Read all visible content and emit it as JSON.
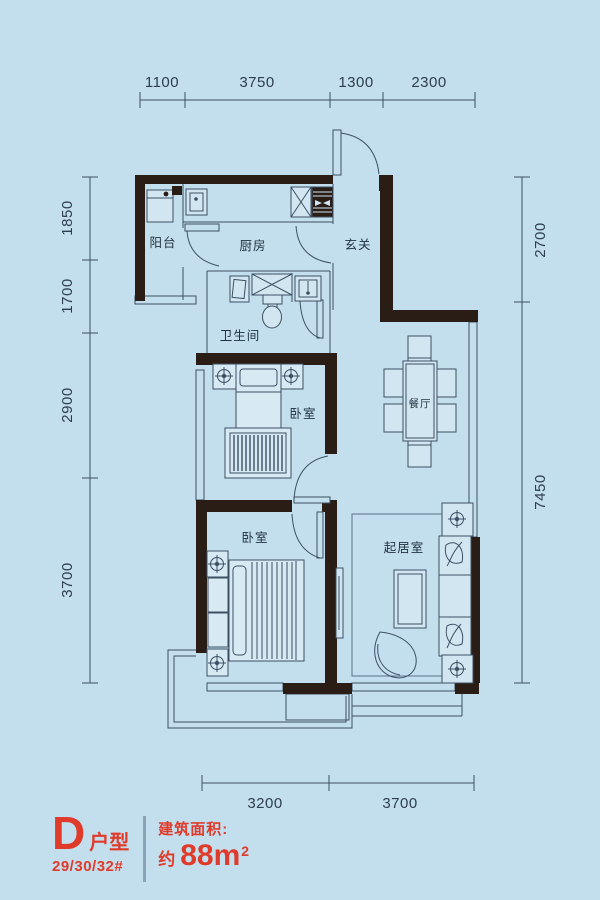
{
  "plan": {
    "rooms": {
      "balcony": "阳台",
      "kitchen": "厨房",
      "entry": "玄关",
      "bath": "卫生间",
      "bedroom_top": "卧室",
      "bedroom_bottom": "卧室",
      "dining": "餐厅",
      "living": "起居室"
    },
    "dims": {
      "top": [
        "1100",
        "3750",
        "1300",
        "2300"
      ],
      "left": [
        "1850",
        "1700",
        "2900",
        "3700"
      ],
      "right": [
        "2700",
        "7450"
      ],
      "bottom": [
        "3200",
        "3700"
      ]
    }
  },
  "title_block": {
    "unit_letter": "D",
    "unit_label": "户型",
    "buildings": "29/30/32#",
    "area_caption": "建筑面积:",
    "area_approx": "约",
    "area_number": "88",
    "area_unit": "m",
    "area_exp": "2"
  },
  "colors": {
    "background": "#c3deec",
    "wall": "#2a1d16",
    "line": "#3c5064",
    "accent_red": "#e03a2a"
  }
}
